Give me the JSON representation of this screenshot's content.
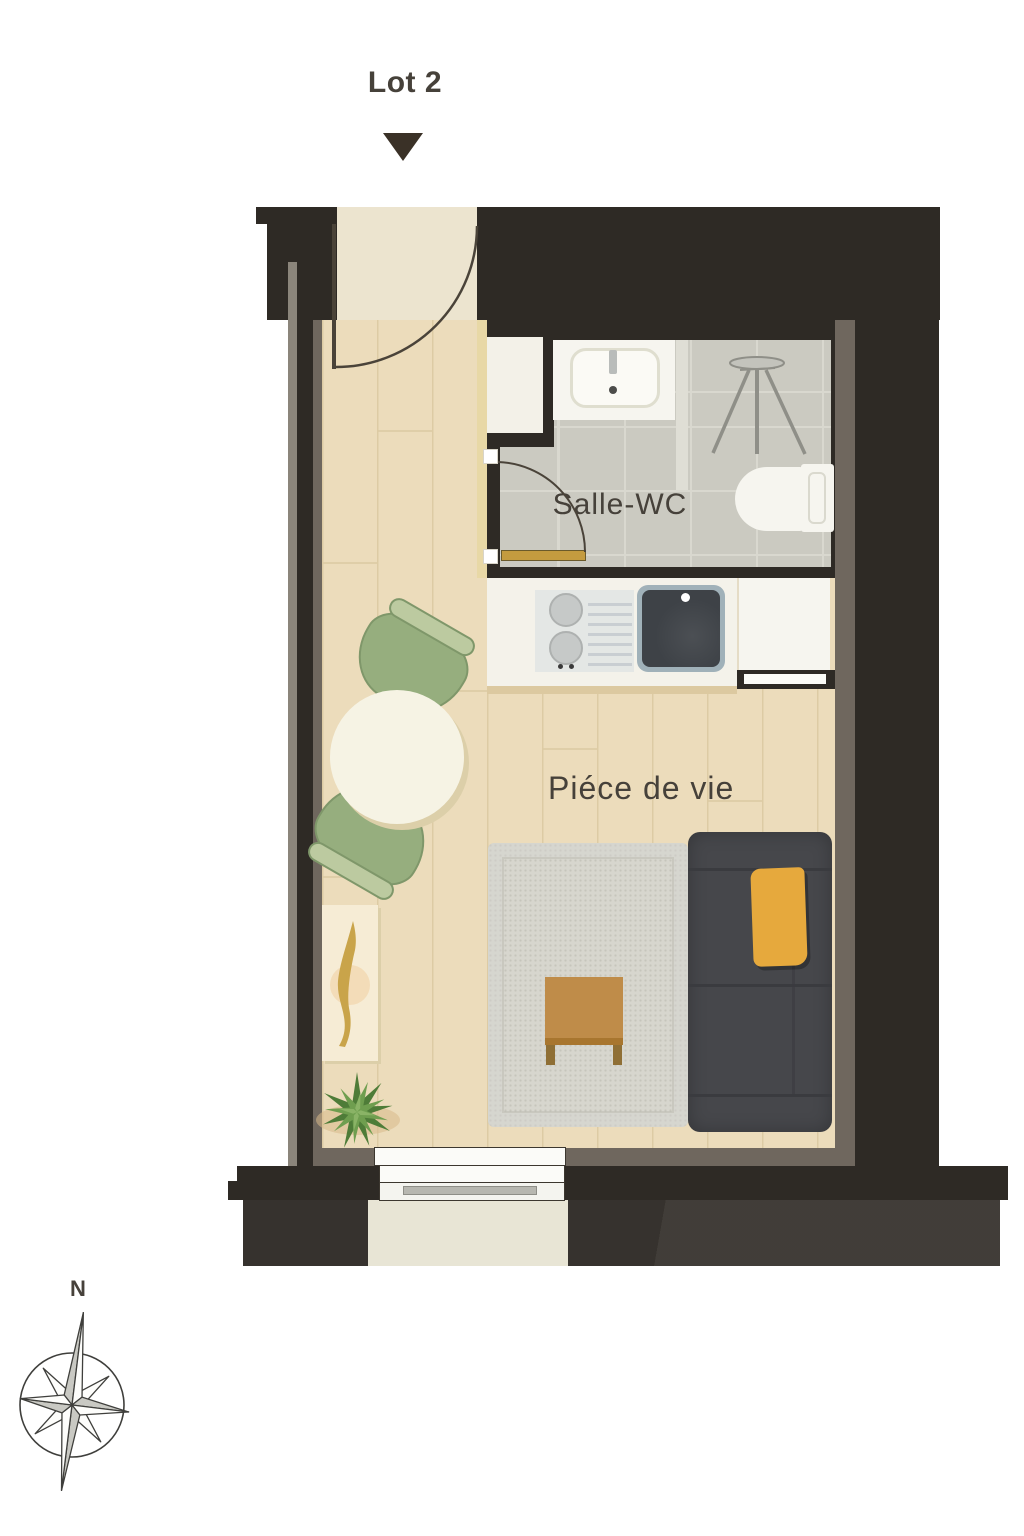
{
  "lot": {
    "label": "Lot 2"
  },
  "rooms": {
    "bathroom_label": "Salle-WC",
    "living_label": "Piéce de vie"
  },
  "compass": {
    "north_label": "N"
  },
  "icons": {
    "lot_marker": "down-triangle-marker",
    "compass": "compass-rose",
    "entry_door": "door-swing-arc",
    "bathroom_door": "door-swing-arc",
    "bathroom_sink": "washbasin",
    "shower_stand": "tripod-shower-stand",
    "toilet": "toilet",
    "cooktop": "two-burner-hob",
    "kitchen_sink": "single-bowl-sink",
    "dining_set": "round-table-two-chairs",
    "sofa": "three-seat-sofa-with-throw",
    "rug": "area-rug",
    "coffee_table": "wood-coffee-table",
    "console": "console-shelf",
    "plant": "potted-plant",
    "window": "window",
    "balcony": "balcony-ledge"
  },
  "colors": {
    "wall_dark": "#2e2a25",
    "wall_inner": "#6f675e",
    "wall_outer_gray": "#8b857b",
    "floor_wood": "#ecdcbb",
    "floor_plank_line": "#ddcba4",
    "door_zone": "#ece4cf",
    "accent_wall_cream": "#e8d8a6",
    "tile": "#cbcac1",
    "tile_line": "#d9d8cf",
    "fixture_white": "#f6f5ef",
    "basin_rim": "#dfdecf",
    "glass_partition": "#dfded5",
    "sink_dark": "#3e4247",
    "sink_rim": "#a0b1b9",
    "cooktop": "#e4e7e5",
    "burner": "#c6c9c8",
    "chair_green": "#96ae7e",
    "chair_band": "#bccaa0",
    "chair_outline": "#7f976a",
    "table_top": "#f6f3e4",
    "table_shadow": "#dccfa9",
    "rug": "#d7d6ce",
    "rug_dot": "#c6c5bc",
    "sofa": "#46474b",
    "sofa_seam": "#3a3b3f",
    "throw_yellow": "#e6a93d",
    "coffee_table": "#bf8c49",
    "coffee_table_edge": "#a8762f",
    "coffee_table_leg": "#8f6f35",
    "console": "#f6ecd5",
    "console_decor": "#c9a44a",
    "console_circle": "#f2d8b0",
    "plant_dark": "#4e7c38",
    "plant_mid": "#6f9e4f",
    "plant_light": "#8ab366",
    "soil": "#d9b98a",
    "door_leaf_gold": "#c49b3f",
    "arc_stroke": "#4a4339",
    "balcony": "#e8e5d5",
    "counter_shadow": "#dcc9a0",
    "text": "#46413a",
    "marker": "#3a3127",
    "compass_fill": "#c9c9c3",
    "compass_stroke": "#3f3f3c",
    "tripod_gray": "#8f8f88",
    "tripod_fill": "#c3c3bc"
  }
}
